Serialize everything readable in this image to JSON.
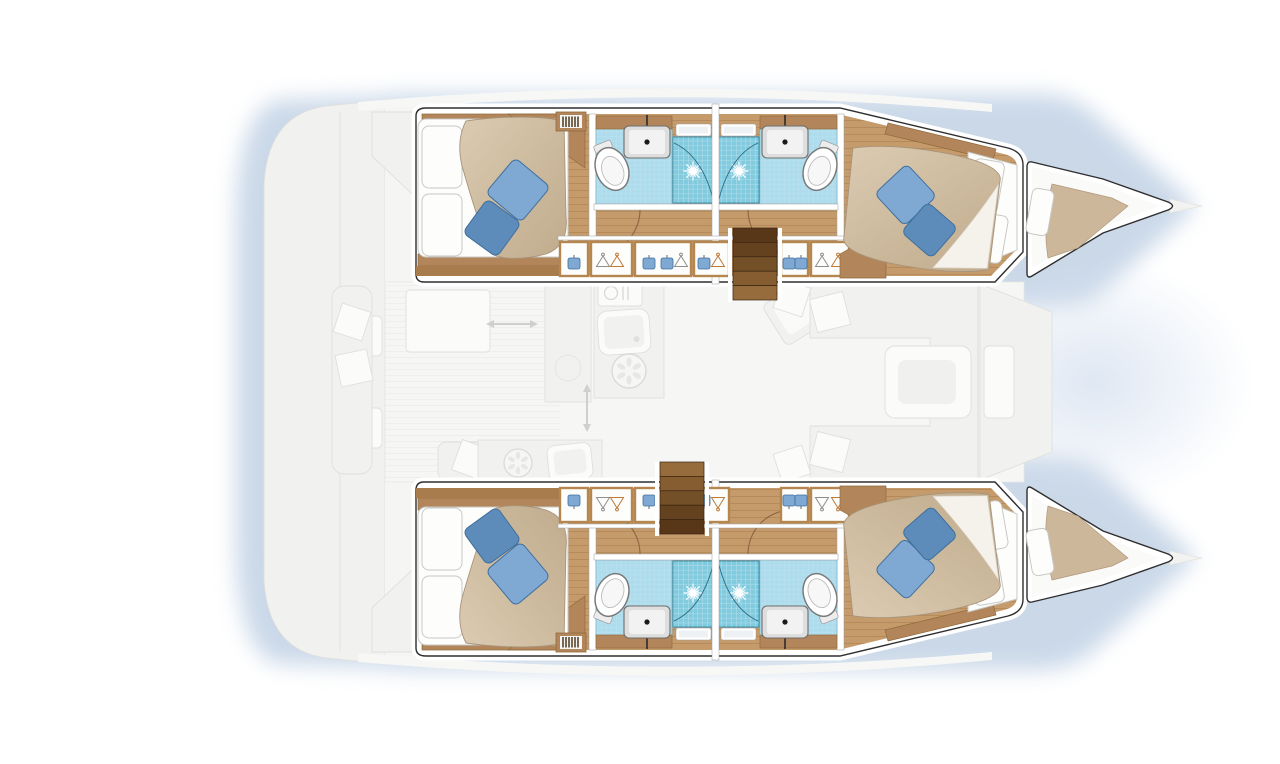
{
  "diagram": {
    "type": "catamaran-deck-plan",
    "hulls": [
      "port-hull",
      "starboard-hull"
    ],
    "areas": [
      "aft-cabin",
      "forward-cabin",
      "head-with-shower",
      "shower-stall",
      "wardrobe-row",
      "companionway-steps",
      "forepeak-berth",
      "saloon-galley-ghosted",
      "aft-cockpit-ghosted",
      "transom-platform-ghosted"
    ],
    "cabin_count": 4,
    "shower_count": 4
  },
  "icons": [
    "toilet-icon",
    "washbasin-icon",
    "faucet-icon",
    "shower-drain-starburst-icon",
    "deck-hatch-icon",
    "clothes-hanger-icon",
    "folded-garment-icon",
    "vent-grate-icon",
    "galley-sink-icon",
    "stove-burner-icon",
    "fridge-cutlery-icon",
    "sliding-door-arrow-icon",
    "mast-post",
    "door-swing-arc",
    "bow-tip"
  ],
  "colors": {
    "bg": "#ffffff",
    "shadowBlue": "#bdcfe3",
    "bowWash": "#d9e3f1",
    "outline": "#2e2e2e",
    "wood": "#c59b6c",
    "woodLine": "#a87e4e",
    "woodTrim": "#b2865a",
    "woodTrimLine": "#8f6a3c",
    "wardrobeFrame": "#b5874f",
    "stairDark": "#583718",
    "stairLight": "#976c3d",
    "duvet": "#cfbca1",
    "duvetHi": "#dbcbb2",
    "duvetLo": "#c0ab8c",
    "duvetEdge": "#a8947a",
    "fold": "#f5f2ec",
    "linen": "#fdfdfc",
    "linenLine": "#c8c8c4",
    "pillowLight": "#7fa9d2",
    "pillowDark": "#5d8cba",
    "pillowEdge": "#3f6f9e",
    "bathFloor": "#aedcec",
    "bathFloorLine": "#79b4cb",
    "showerTile": "#82cbdf",
    "showerEdge": "#3f93b0",
    "blanketTan": "#ccb79b",
    "arcBrown": "#8a6540",
    "ghost": "#f1f1f0",
    "ghostLine": "#dfdfdd",
    "ghostDark": "#e7e7e5"
  }
}
